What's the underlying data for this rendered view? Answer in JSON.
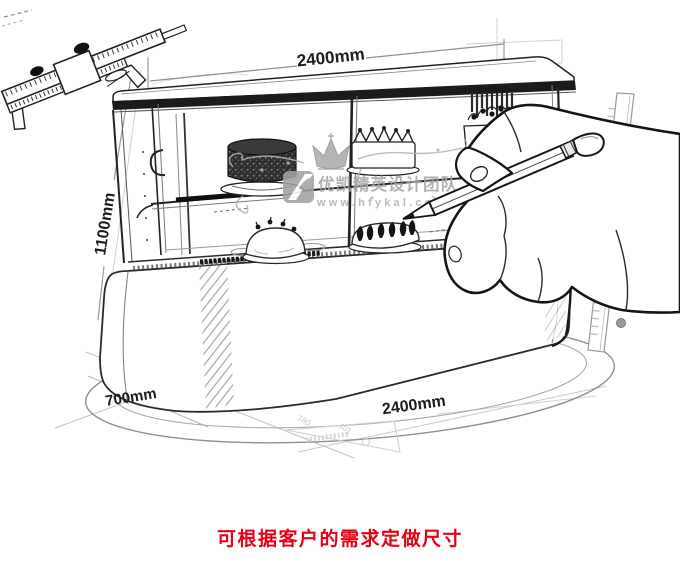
{
  "scene": {
    "description": "Pencil-sketch concept drawing of a curved-glass cake display showcase on an oval plinth, annotated with dimensions, being drawn by a hand holding a pencil, with a vernier caliper and rulers",
    "background_color": "#ffffff",
    "ink_color": "#222222"
  },
  "dimensions": {
    "top_width": "2400mm",
    "height": "1100mm",
    "depth": "700mm",
    "bottom_width": "2400mm"
  },
  "sketch_marks": {
    "mark1": "180",
    "mark2": "401"
  },
  "watermark": {
    "brand": "优凯精英设计团队",
    "url": "www.hfykal.com",
    "text_color": "#a8a8a8",
    "crown_icon": "crown",
    "logo_icon": "yk-monogram"
  },
  "caption": {
    "text": "可根据客户的需求定做尺寸",
    "color": "#e60012"
  }
}
